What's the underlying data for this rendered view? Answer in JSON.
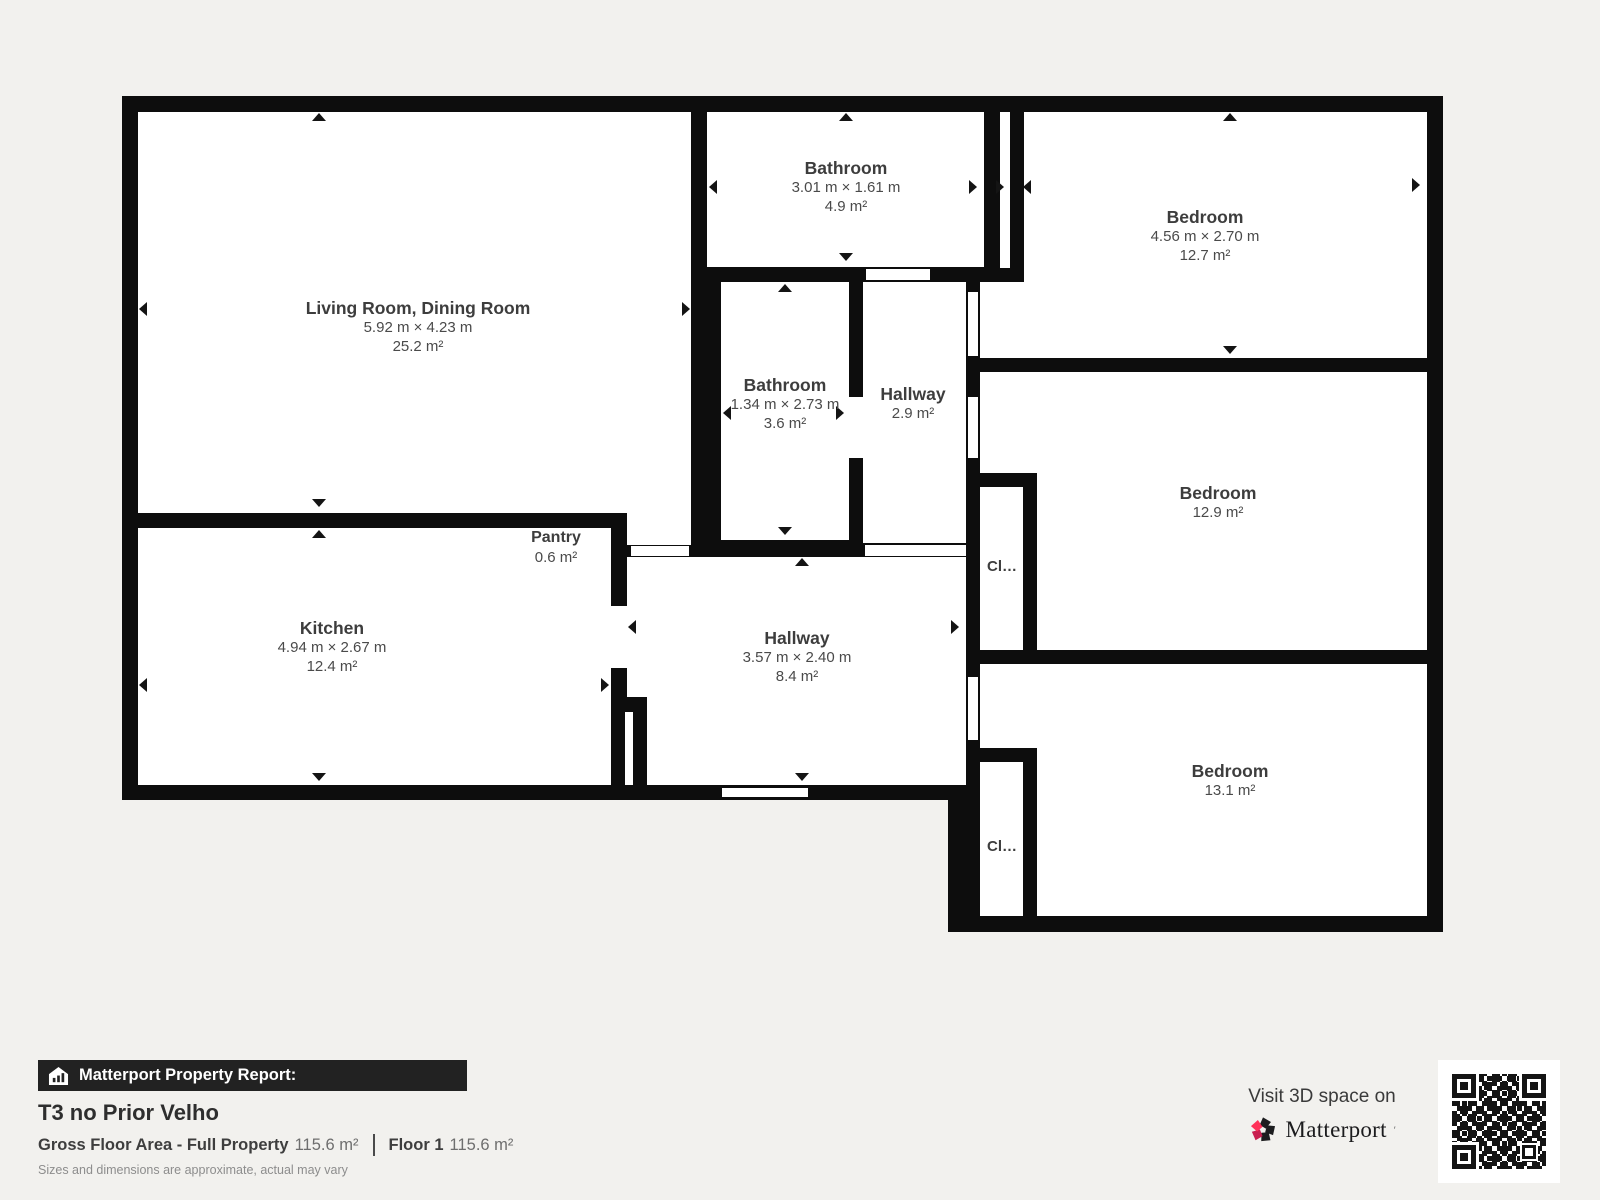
{
  "rooms": {
    "living": {
      "name": "Living Room, Dining Room",
      "dims": "5.92 m × 4.23 m",
      "area": "25.2 m²"
    },
    "bath_top": {
      "name": "Bathroom",
      "dims": "3.01 m × 1.61 m",
      "area": "4.9 m²"
    },
    "bed_top": {
      "name": "Bedroom",
      "dims": "4.56 m × 2.70 m",
      "area": "12.7 m²"
    },
    "bath_mid": {
      "name": "Bathroom",
      "dims": "1.34 m × 2.73 m",
      "area": "3.6 m²"
    },
    "hall_small": {
      "name": "Hallway",
      "area": "2.9 m²"
    },
    "bed_mid": {
      "name": "Bedroom",
      "area": "12.9 m²"
    },
    "kitchen": {
      "name": "Kitchen",
      "dims": "4.94 m × 2.67 m",
      "area": "12.4 m²"
    },
    "pantry": {
      "name": "Pantry",
      "area": "0.6 m²"
    },
    "hall_main": {
      "name": "Hallway",
      "dims": "3.57 m × 2.40 m",
      "area": "8.4 m²"
    },
    "bed_bottom": {
      "name": "Bedroom",
      "area": "13.1 m²"
    },
    "closet_mid": {
      "label": "Cl…"
    },
    "closet_bottom": {
      "label": "Cl…"
    }
  },
  "footer": {
    "report_label": "Matterport Property Report:",
    "title": "T3 no Prior Velho",
    "gross_label": "Gross Floor Area - Full Property",
    "gross_value": "115.6 m²",
    "floor_label": "Floor 1",
    "floor_value": "115.6 m²",
    "disclaimer": "Sizes and dimensions are approximate, actual may vary"
  },
  "promo": {
    "visit_text": "Visit 3D space on",
    "brand": "Matterport",
    "brand_mark": "′"
  },
  "colors": {
    "wall": "#0d0d0d",
    "background": "#f2f1ee",
    "room_fill": "#ffffff",
    "accent_pink": "#ff3158",
    "accent_dark_pink": "#c81f4f",
    "text": "#4a4a4a"
  }
}
